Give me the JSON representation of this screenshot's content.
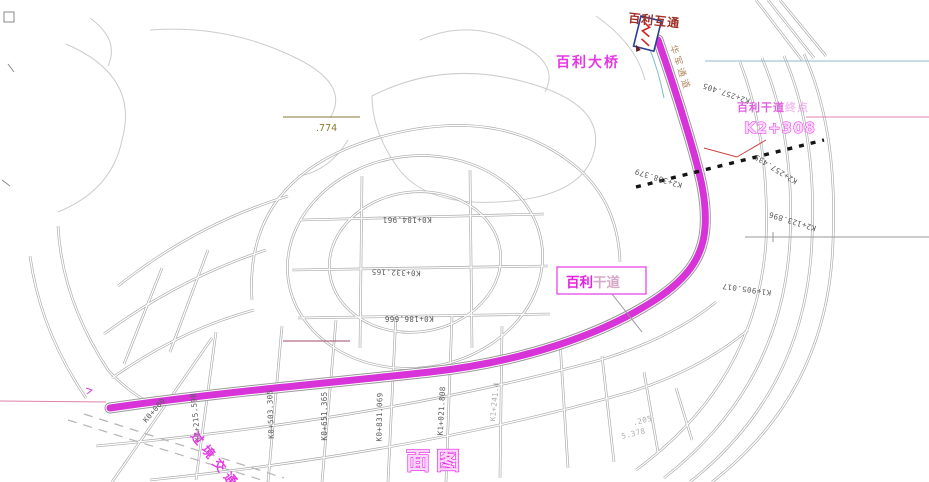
{
  "labels": {
    "plan_title": "面图",
    "bridge_name": "百利大桥",
    "interchange_name": "百利互通",
    "passage_name": "华军通道",
    "route_end_prefix": "百利干道",
    "route_end_suffix": "终点",
    "route_end_station": "K2+308",
    "route_box_bold": "百利",
    "route_box_light": "干道",
    "through_traffic": "过境交通",
    "dim_774": ".774"
  },
  "stations": {
    "bottom": [
      "K0+000",
      "K0+215.598",
      "K0+503.305",
      "K0+651.365",
      "K0+831.069",
      "K1+021.808",
      "K1+241.4"
    ],
    "inner_grid": [
      "K0+184.961",
      "K0+332.165",
      "K0+186.666"
    ],
    "upper": [
      "K2+257.405",
      "K2+308.379",
      "K2+257.435",
      "K2+123.896",
      "K1+905.017"
    ],
    "fragments": [
      ".205",
      "5.378"
    ]
  },
  "colors": {
    "route_magenta": "#d833d8",
    "label_magenta": "#e538e5",
    "dark_red": "#a03028",
    "olive": "#8a7a30",
    "road_gray": "#a9a9a9",
    "cyan_line": "#8fb9c9",
    "pink_line": "#e080ac",
    "dotted_line_black": "#151515"
  }
}
